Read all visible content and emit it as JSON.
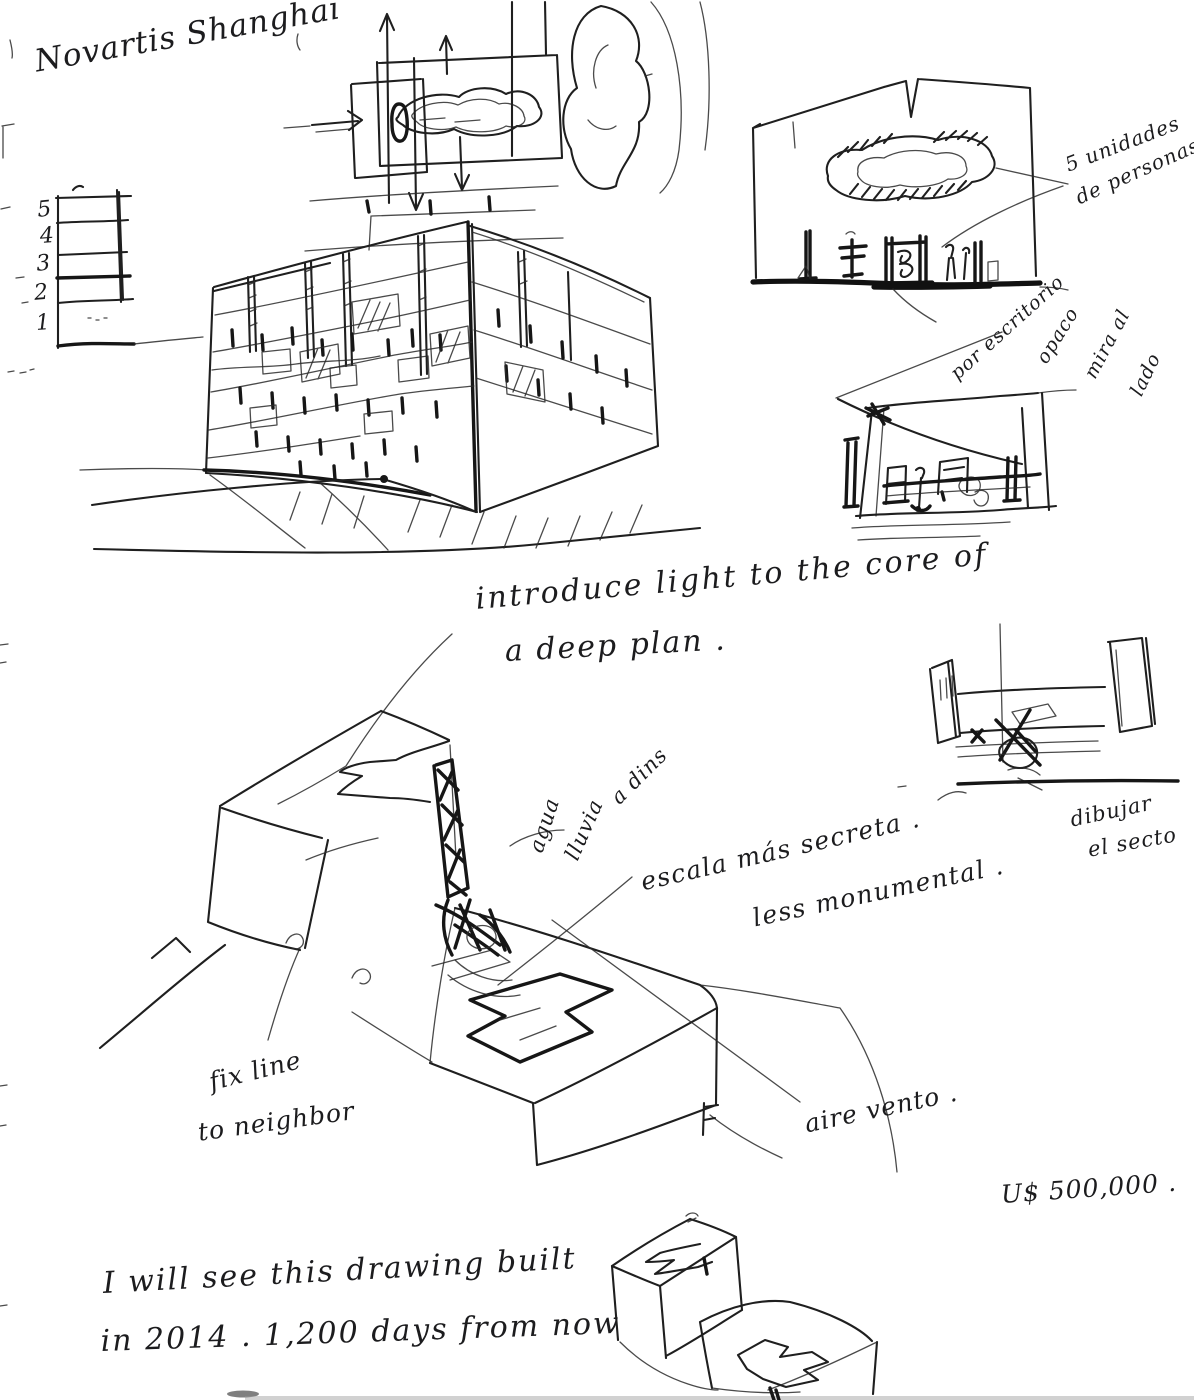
{
  "colors": {
    "ink": "#1f1f1f",
    "paper": "#ffffff"
  },
  "annotations": {
    "title": "Novartis Shanghai",
    "floors": [
      "5",
      "4",
      "3",
      "2",
      "1"
    ],
    "unidades_lines": [
      "5 unidades",
      "de personas"
    ],
    "por_escritorio": "por escritorio",
    "opaco_words": [
      "opaco",
      "mira al",
      "lado"
    ],
    "introduce_lines": [
      "introduce light to the core of",
      "a deep plan ."
    ],
    "agua_words": [
      "agua",
      "lluvia",
      "a dins"
    ],
    "escala": "escala más secreta .",
    "monumental": "less monumental .",
    "dibujar_lines": [
      "dibujar",
      "el secto"
    ],
    "fix_lines": [
      "fix line",
      "to neighbor"
    ],
    "aire": "aire vento .",
    "price": "U$ 500,000 .",
    "closing_lines": [
      "I will see this drawing built",
      "in 2014 . 1,200 days from now"
    ]
  }
}
